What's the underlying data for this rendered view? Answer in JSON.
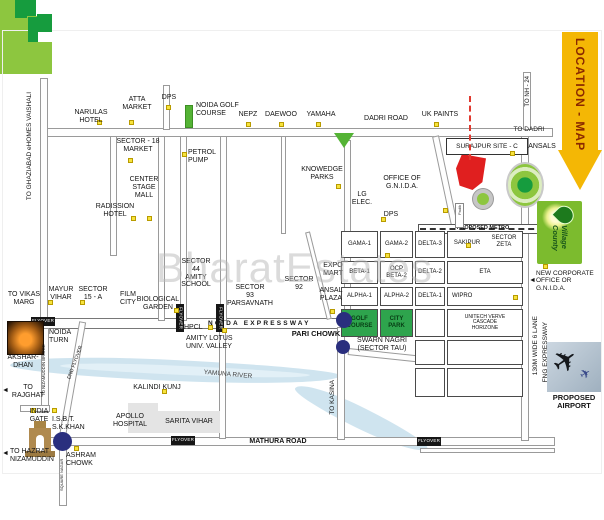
{
  "banner": {
    "label": "LOCATION - MAP"
  },
  "watermark": "BharatEstates",
  "colors": {
    "site_red": "#e01f1f",
    "park_green_dark": "#169c3e",
    "park_green_light": "#8dc63f",
    "marker_yellow": "#f7e33d",
    "river_blue": "#cfe4ef",
    "banner_yellow": "#f4b705",
    "junction_dot_navy": "#2a2f7e"
  },
  "labels": {
    "arrow_left": "◄",
    "ghaziabad": "TO GHAZIABAD eHOMES VAISHALI",
    "narulas": "NARULAS HOTEL",
    "atta": "ATTA\nMARKET",
    "dps1": "DPS",
    "noida_golf": "NOIDA GOLF\nCOURSE",
    "nepz": "NEPZ",
    "daewoo": "DAEWOO",
    "yamaha": "YAMAHA",
    "dadri_road": "DADRI ROAD",
    "uk_paints": "UK PAINTS",
    "to_nh24": "TO NH - 24",
    "to_dadri": "TO DADRI",
    "ansals": "ANSALS",
    "surajpur": "SURAJPUR SITE - C",
    "sec18": "SECTOR - 18\nMARKET",
    "petrol": "PETROL\nPUMP",
    "center_stage": "CENTER\nSTAGE\nMALL",
    "radisson": "RADISSION\nHOTEL",
    "knowledge": "KNOWEDGE\nPARKS",
    "gnida_office": "OFFICE OF\nG.N.I.D.A.",
    "lg": "LG\nELEC.",
    "dps2": "DPS",
    "metro": "PROPOSED METRO",
    "padik": "Padik",
    "expo": "EXPO\nMART",
    "ansal_plaza": "ANSAL\nPLAZA",
    "sec92": "SECTOR\n92",
    "sec93": "SECTOR\n93\nPARSAVNATH",
    "sec44": "SECTOR\n44\nAMITY\nSCHOOL",
    "mayur": "MAYUR\nVIHAR",
    "sec15a": "SECTOR\n15 - A",
    "film": "FILM\nCITY",
    "biological": "BIOLOGICAL\nGARDEN",
    "expressway": "NOIDA EXPRESSWAY",
    "pari_chowk": "PARI CHOWK",
    "hpcl": "HPCL",
    "amity_lotus": "AMITY LOTUS\nUNIV. VALLEY",
    "flyover": "FLYOVER",
    "to_vikas": "TO VIKAS\nMARG",
    "noida_turn": "NOIDA\nTURN",
    "nizamuddin_bridge": "TO NIZAMUDDIN BRIDGE",
    "dnd": "DND FLYOVER",
    "akshardhan": "AKSHAR-\nDHAN",
    "to_rajghat": "TO\nRAJGHAT",
    "india_gate": "INDIA\nGATE",
    "isbt": "I.S.B.T.\nS.K.KHAN",
    "to_hazrat": "TO HAZRAT\nNIZAMUDDIN",
    "ashram": "ASHRAM\nCHOWK",
    "square_nagar": "SQUARE NAGAR",
    "yamuna": "YAMUNA RIVER",
    "kalindi": "KALINDI KUNJ",
    "apollo": "APOLLO\nHOSPITAL",
    "sarita": "SARITA VIHAR",
    "mathura": "MATHURA ROAD",
    "swarn": "SWARN NAGRI\n(SECTOR TAU)",
    "to_kasina": "TO KASINA",
    "fng1": "130M WIDE 6 LANE",
    "fng2": "FNG EXPRESSWAY",
    "new_corp": "NEW CORPORATE\nOFFICE OR\nG.N.I.D.A.",
    "airport": "PROPOSED\nAIRPORT",
    "village_county": "Village County"
  },
  "sectors": {
    "gama1": "GAMA-1",
    "gama2": "GAMA-2",
    "delta3": "DELTA-3",
    "sakipur": "SAKIPUR",
    "zeta": "SECTOR\nZETA",
    "beta1": "BETA-1",
    "ocp_beta2": "OCP\nBETA-2",
    "delta2": "DELTA-2",
    "eta": "ETA",
    "alpha1": "ALPHA-1",
    "alpha2": "ALPHA-2",
    "delta1": "DELTA-1",
    "wipro": "WIPRO",
    "golf": "GOLF\nCOURSE",
    "city_park": "CITY\nPARK",
    "unitech": "UNITECH VERVE\nCASCADE\nHORIZONE"
  }
}
